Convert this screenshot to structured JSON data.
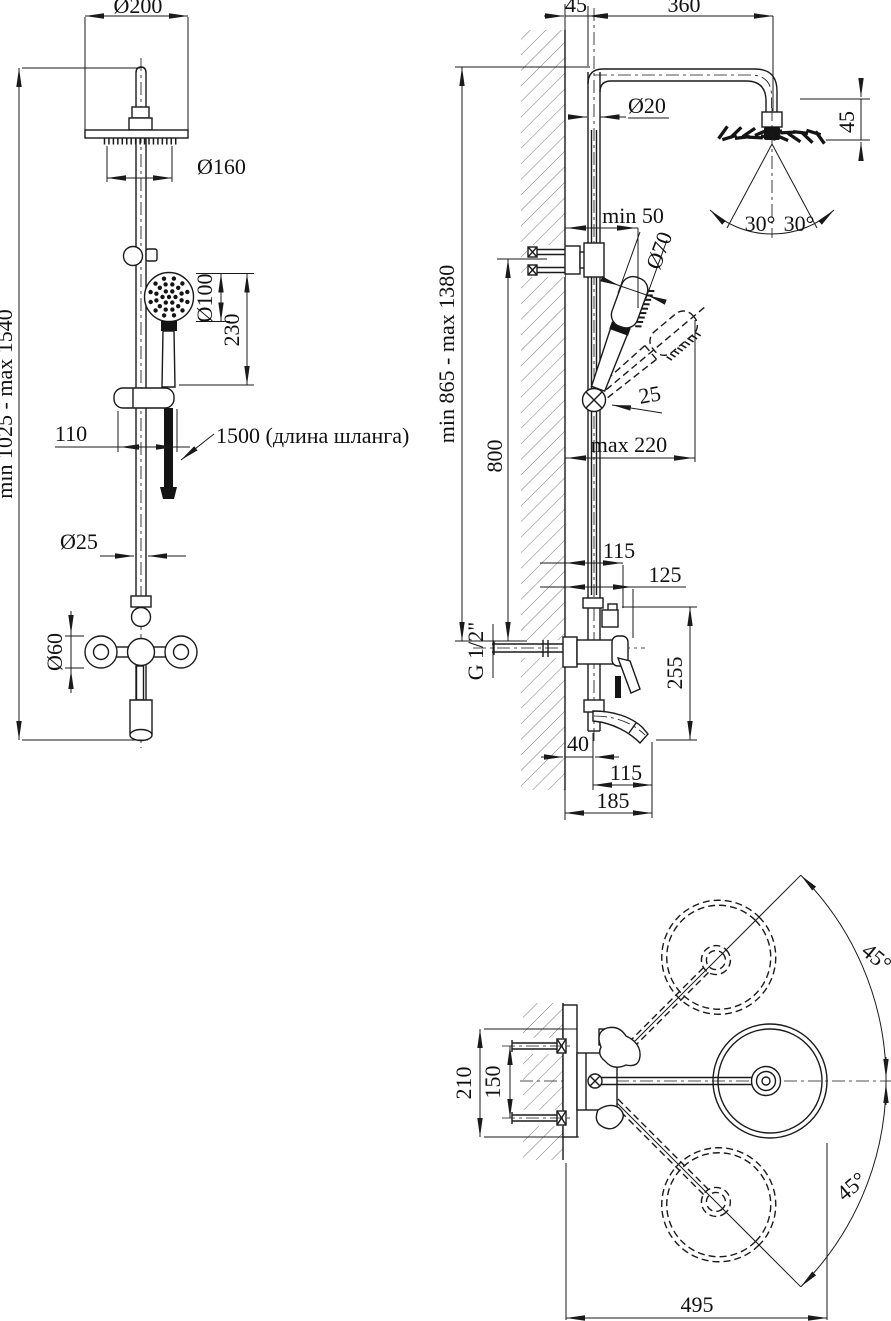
{
  "drawing": {
    "background": "#ffffff",
    "line_color": "#1a1a1a",
    "views": {
      "front": {
        "dims": {
          "head_diameter": "Ø200",
          "rain_diameter": "Ø160",
          "hand_diameter": "Ø100",
          "hand_length": "230",
          "bracket_offset": "110",
          "hose_note": "1500 (длина шланга)",
          "pipe_diameter": "Ø25",
          "handle_diameter": "Ø60",
          "height_range": "min 1025 - max 1540"
        }
      },
      "side": {
        "dims": {
          "wall_offset": "45",
          "arm_length": "360",
          "pipe_diameter": "Ø20",
          "head_height": "45",
          "spray_angle_left": "30°",
          "spray_angle_right": "30°",
          "wall_clearance": "min 50",
          "hand_head_diameter": "Ø70",
          "pivot_offset": "25",
          "reach": "max 220",
          "bracket_height": "800",
          "height_range": "min 865 - max 1380",
          "upper_offset": "115",
          "lever_offset": "125",
          "thread": "G 1/2\"",
          "spout_drop": "255",
          "wall_gap": "40",
          "spout_reach": "115",
          "total_reach": "185"
        }
      },
      "top": {
        "dims": {
          "swivel_upper": "45°",
          "swivel_lower": "45°",
          "plate_height": "210",
          "bolt_spacing": "150",
          "total_width": "495"
        }
      }
    }
  }
}
